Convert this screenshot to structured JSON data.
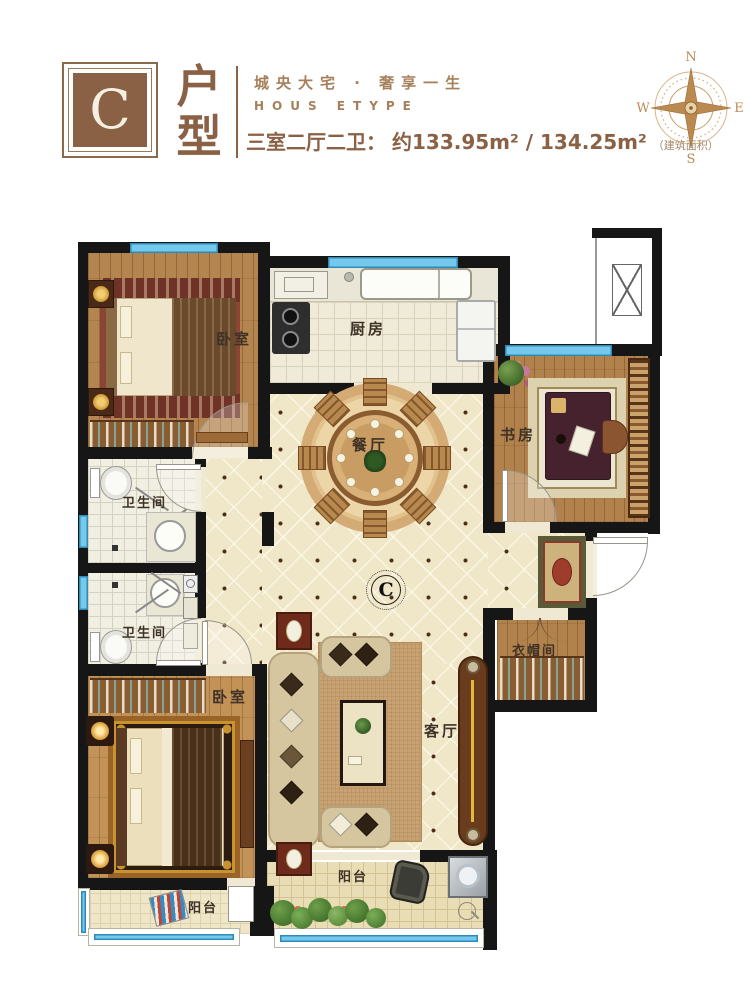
{
  "header": {
    "logo_letter": "C",
    "unit_char_1": "户",
    "unit_char_2": "型",
    "tagline_cn": "城央大宅 · 奢享一生",
    "tagline_en": "HOUS ETYPE",
    "spec_label": "三室二厅二卫：",
    "area_value": "约133.95m² / 134.25m²",
    "area_note": "（建筑面积）"
  },
  "compass": {
    "north": "N",
    "east": "E",
    "south": "S",
    "west": "W"
  },
  "floorplan": {
    "marker": "C",
    "rooms": {
      "bedroom_top": "卧室",
      "kitchen": "厨房",
      "dining": "餐厅",
      "study": "书房",
      "bath_upper": "卫生间",
      "bath_lower": "卫生间",
      "living": "客厅",
      "cloakroom": "衣帽间",
      "bedroom_bottom": "卧室",
      "balcony_left": "阳台",
      "balcony_main": "阳台"
    },
    "colors": {
      "accent_brown": "#8a6144",
      "wall_black": "#161616",
      "window_blue": "#74c9ec",
      "tile_beige": "#f0e6c8"
    }
  }
}
